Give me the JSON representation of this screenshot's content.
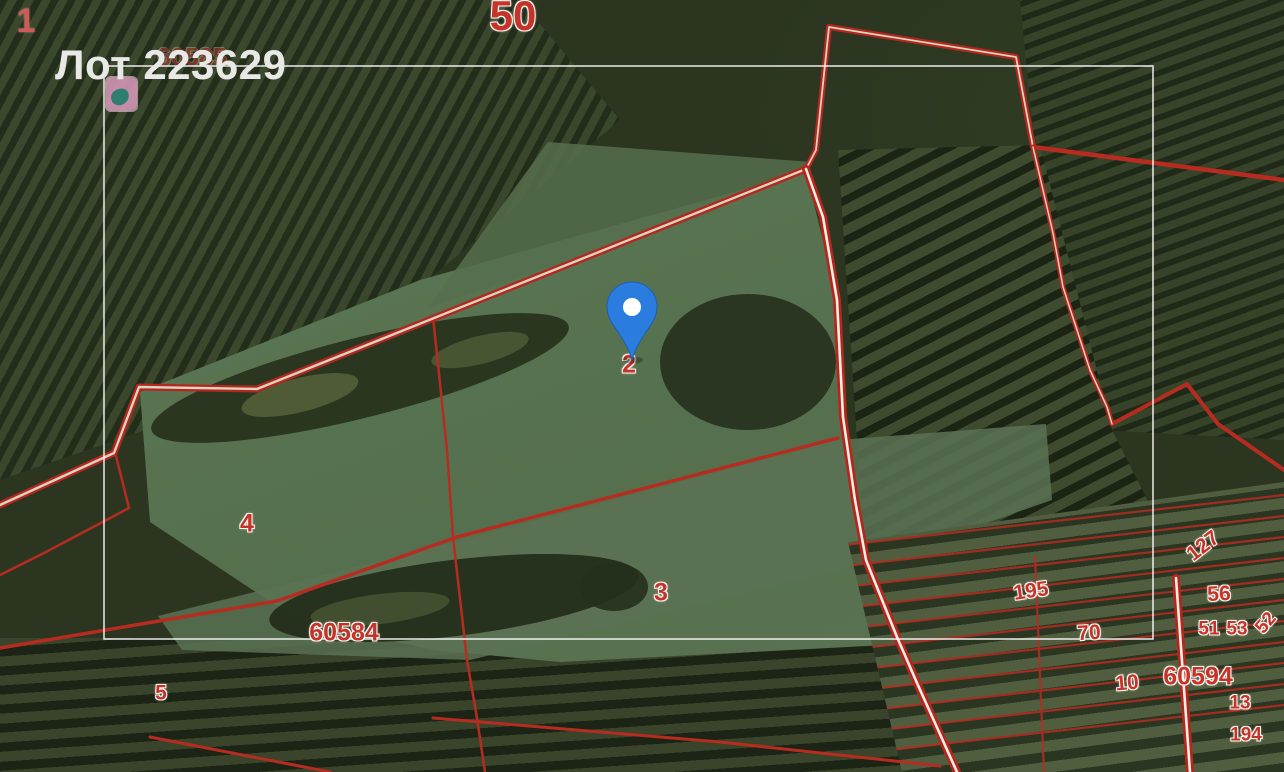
{
  "title": {
    "text": "Лот 223629"
  },
  "labels": {
    "corner1": "1",
    "quarter50": "50",
    "faded60585": "60585",
    "parcel2": "2",
    "parcel3": "3",
    "parcel4": "4",
    "parcel5": "5",
    "block60584": "60584",
    "block60594": "60594",
    "plot195": "195",
    "plot70": "70",
    "plot127": "127",
    "plot56": "56",
    "plot51": "51",
    "plot53": "53",
    "plot52": "52",
    "plot10": "10",
    "plot13": "13",
    "plot194": "194"
  },
  "colors": {
    "cadastral_red": "#c0281e",
    "road_center_white": "#ffffff",
    "highlight_white": "#ffffff",
    "pin_blue": "#2a7cdf",
    "title_gray": "#e8e8e6",
    "field_green": "#5d7556"
  },
  "icons": {
    "pin": "map-pin-icon",
    "poi": "poi-marker-icon"
  }
}
